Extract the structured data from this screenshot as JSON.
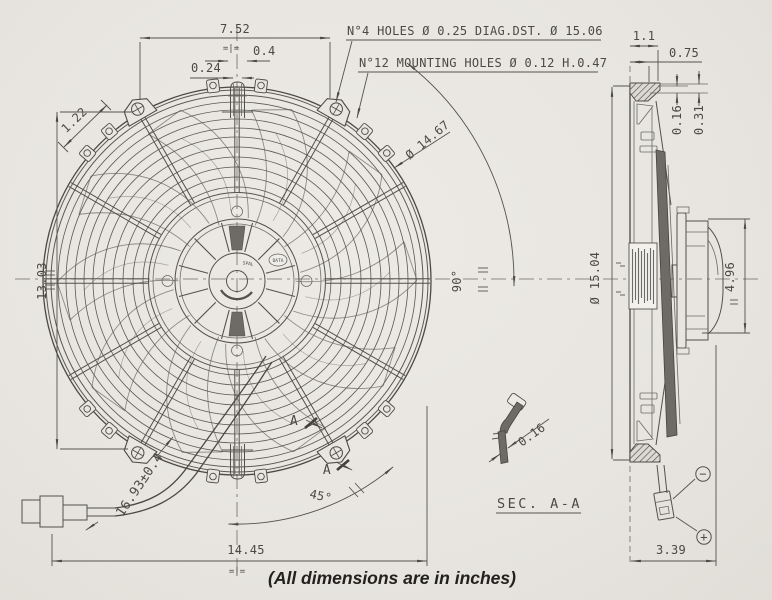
{
  "drawing": {
    "footer": "(All dimensions are in inches)",
    "notes": {
      "holes4": "N°4 HOLES Ø 0.25 DIAG.DST. Ø 15.06",
      "holes12": "N°12 MOUNTING HOLES Ø 0.12 H.0.47"
    },
    "front": {
      "dim_top_width": "7.52",
      "dim_tab_width": "0.4",
      "dim_tab_offset": "0.24",
      "dim_slot": "1.22",
      "dim_height": "13.03",
      "dim_width": "14.45",
      "dim_wire": "16.93±0.4",
      "dim_blade_dia": "Ø 14.67",
      "angle_45": "45°",
      "angle_90": "90°",
      "section_letter_1": "A",
      "section_letter_2": "A",
      "hub_badge": "DATA",
      "hub_brand": "SPAL",
      "datum_top": "=|=",
      "datum_bottom": "=|="
    },
    "side": {
      "dim_flange": "1.1",
      "dim_depth_front": "0.75",
      "dim_step_1": "0.16",
      "dim_step_2": "0.31",
      "dim_overall_dia": "Ø 15.04",
      "dim_motor_dia": "4.96",
      "dim_depth": "3.39",
      "polarity_minus": "−",
      "polarity_plus": "+"
    },
    "section_detail": {
      "label": "SEC. A-A",
      "dim_thickness": "0.16"
    }
  }
}
